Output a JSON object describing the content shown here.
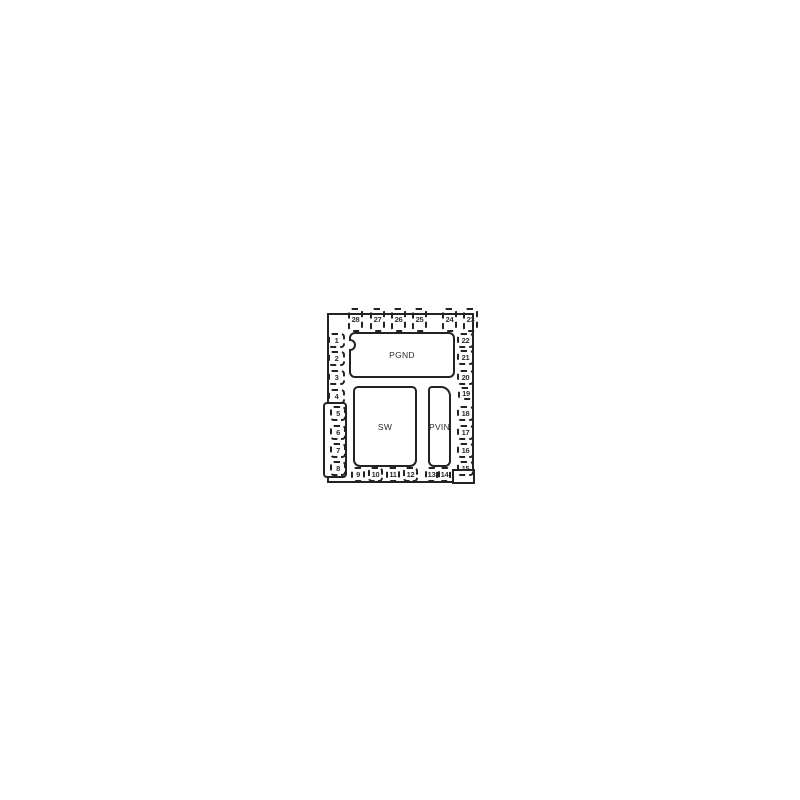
{
  "package": {
    "pads": [
      {
        "id": "pgnd",
        "label": "PGND"
      },
      {
        "id": "sw",
        "label": "SW"
      },
      {
        "id": "pvin",
        "label": "PVIN"
      }
    ],
    "pins": [
      {
        "label": "1",
        "side": "left",
        "x": 328,
        "y": 333,
        "w": 17,
        "h": 15
      },
      {
        "label": "2",
        "side": "left",
        "x": 328,
        "y": 351,
        "w": 17,
        "h": 15
      },
      {
        "label": "3",
        "side": "left",
        "x": 328,
        "y": 370,
        "w": 17,
        "h": 15
      },
      {
        "label": "4",
        "side": "left",
        "x": 328,
        "y": 389,
        "w": 17,
        "h": 15
      },
      {
        "label": "5",
        "side": "left",
        "x": 330,
        "y": 406,
        "w": 16,
        "h": 15
      },
      {
        "label": "6",
        "side": "left",
        "x": 330,
        "y": 425,
        "w": 16,
        "h": 15
      },
      {
        "label": "7",
        "side": "left",
        "x": 330,
        "y": 443,
        "w": 16,
        "h": 15
      },
      {
        "label": "8",
        "side": "left",
        "x": 330,
        "y": 461,
        "w": 16,
        "h": 15
      },
      {
        "label": "9",
        "side": "bottom",
        "x": 351,
        "y": 467,
        "w": 14,
        "h": 15
      },
      {
        "label": "10",
        "side": "bottom",
        "x": 368,
        "y": 467,
        "w": 15,
        "h": 15
      },
      {
        "label": "11",
        "side": "bottom",
        "x": 386,
        "y": 467,
        "w": 14,
        "h": 15
      },
      {
        "label": "12",
        "side": "bottom",
        "x": 403,
        "y": 467,
        "w": 15,
        "h": 15
      },
      {
        "label": "13",
        "side": "bottom",
        "x": 425,
        "y": 467,
        "w": 13,
        "h": 15
      },
      {
        "label": "14",
        "side": "bottom",
        "x": 438,
        "y": 467,
        "w": 13,
        "h": 15
      },
      {
        "label": "15",
        "side": "right",
        "x": 457,
        "y": 461,
        "w": 17,
        "h": 15
      },
      {
        "label": "16",
        "side": "right",
        "x": 457,
        "y": 443,
        "w": 17,
        "h": 15
      },
      {
        "label": "17",
        "side": "right",
        "x": 457,
        "y": 425,
        "w": 17,
        "h": 15
      },
      {
        "label": "18",
        "side": "right",
        "x": 457,
        "y": 406,
        "w": 17,
        "h": 15
      },
      {
        "label": "19",
        "side": "right",
        "x": 458,
        "y": 387,
        "w": 16,
        "h": 13
      },
      {
        "label": "20",
        "side": "right",
        "x": 457,
        "y": 370,
        "w": 17,
        "h": 15
      },
      {
        "label": "21",
        "side": "right",
        "x": 457,
        "y": 350,
        "w": 17,
        "h": 15
      },
      {
        "label": "22",
        "side": "right",
        "x": 457,
        "y": 333,
        "w": 17,
        "h": 15
      },
      {
        "label": "23",
        "side": "top",
        "x": 463,
        "y": 308,
        "w": 15,
        "h": 24
      },
      {
        "label": "24",
        "side": "top",
        "x": 442,
        "y": 308,
        "w": 15,
        "h": 24
      },
      {
        "label": "25",
        "side": "top",
        "x": 412,
        "y": 308,
        "w": 15,
        "h": 24
      },
      {
        "label": "26",
        "side": "top",
        "x": 391,
        "y": 308,
        "w": 15,
        "h": 24
      },
      {
        "label": "27",
        "side": "top",
        "x": 370,
        "y": 308,
        "w": 15,
        "h": 24
      },
      {
        "label": "28",
        "side": "top",
        "x": 348,
        "y": 308,
        "w": 15,
        "h": 24
      }
    ]
  },
  "colors": {
    "line": "#232323",
    "background": "#ffffff",
    "text": "#2e2e2e"
  }
}
